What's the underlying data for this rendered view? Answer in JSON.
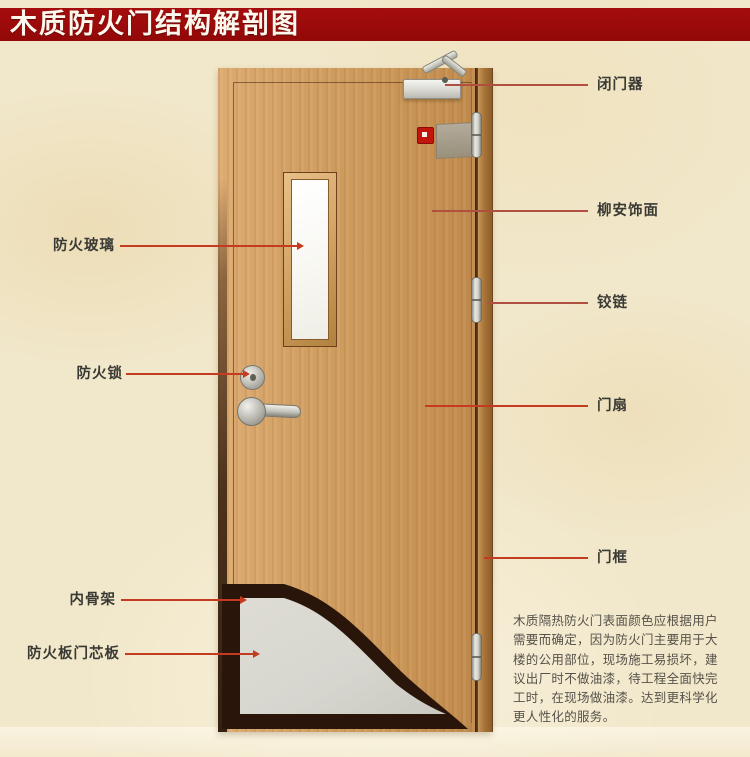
{
  "title": "木质防火门结构解剖图",
  "labels": {
    "left": [
      {
        "id": "fire-glass",
        "text": "防火玻璃"
      },
      {
        "id": "fire-lock",
        "text": "防火锁"
      },
      {
        "id": "inner-skeleton",
        "text": "内骨架"
      },
      {
        "id": "fireproof-core-board",
        "text": "防火板门芯板"
      }
    ],
    "right": [
      {
        "id": "door-closer",
        "text": "闭门器"
      },
      {
        "id": "lauan-veneer",
        "text": "柳安饰面"
      },
      {
        "id": "hinge",
        "text": "铰链"
      },
      {
        "id": "door-leaf",
        "text": "门扇"
      },
      {
        "id": "door-frame",
        "text": "门框"
      }
    ]
  },
  "note": {
    "lines": [
      "木质隔热防火门表面颜色应根据用户",
      "需要而确定，因为防火门主要用于大",
      "楼的公用部位，现场施工易损坏，建",
      "议出厂时不做油漆，待工程全面快完",
      "工时，在现场做油漆。达到更科学化",
      "更人性化的服务。"
    ]
  },
  "colors": {
    "banner_red": "#9d0b0b",
    "callout_red": "#c43b20",
    "background_beige": "#f1e7ca",
    "door_wood": "#cd9a5e",
    "core_gray": "#d6d6cf",
    "cutaway_dark": "#2a150a"
  }
}
